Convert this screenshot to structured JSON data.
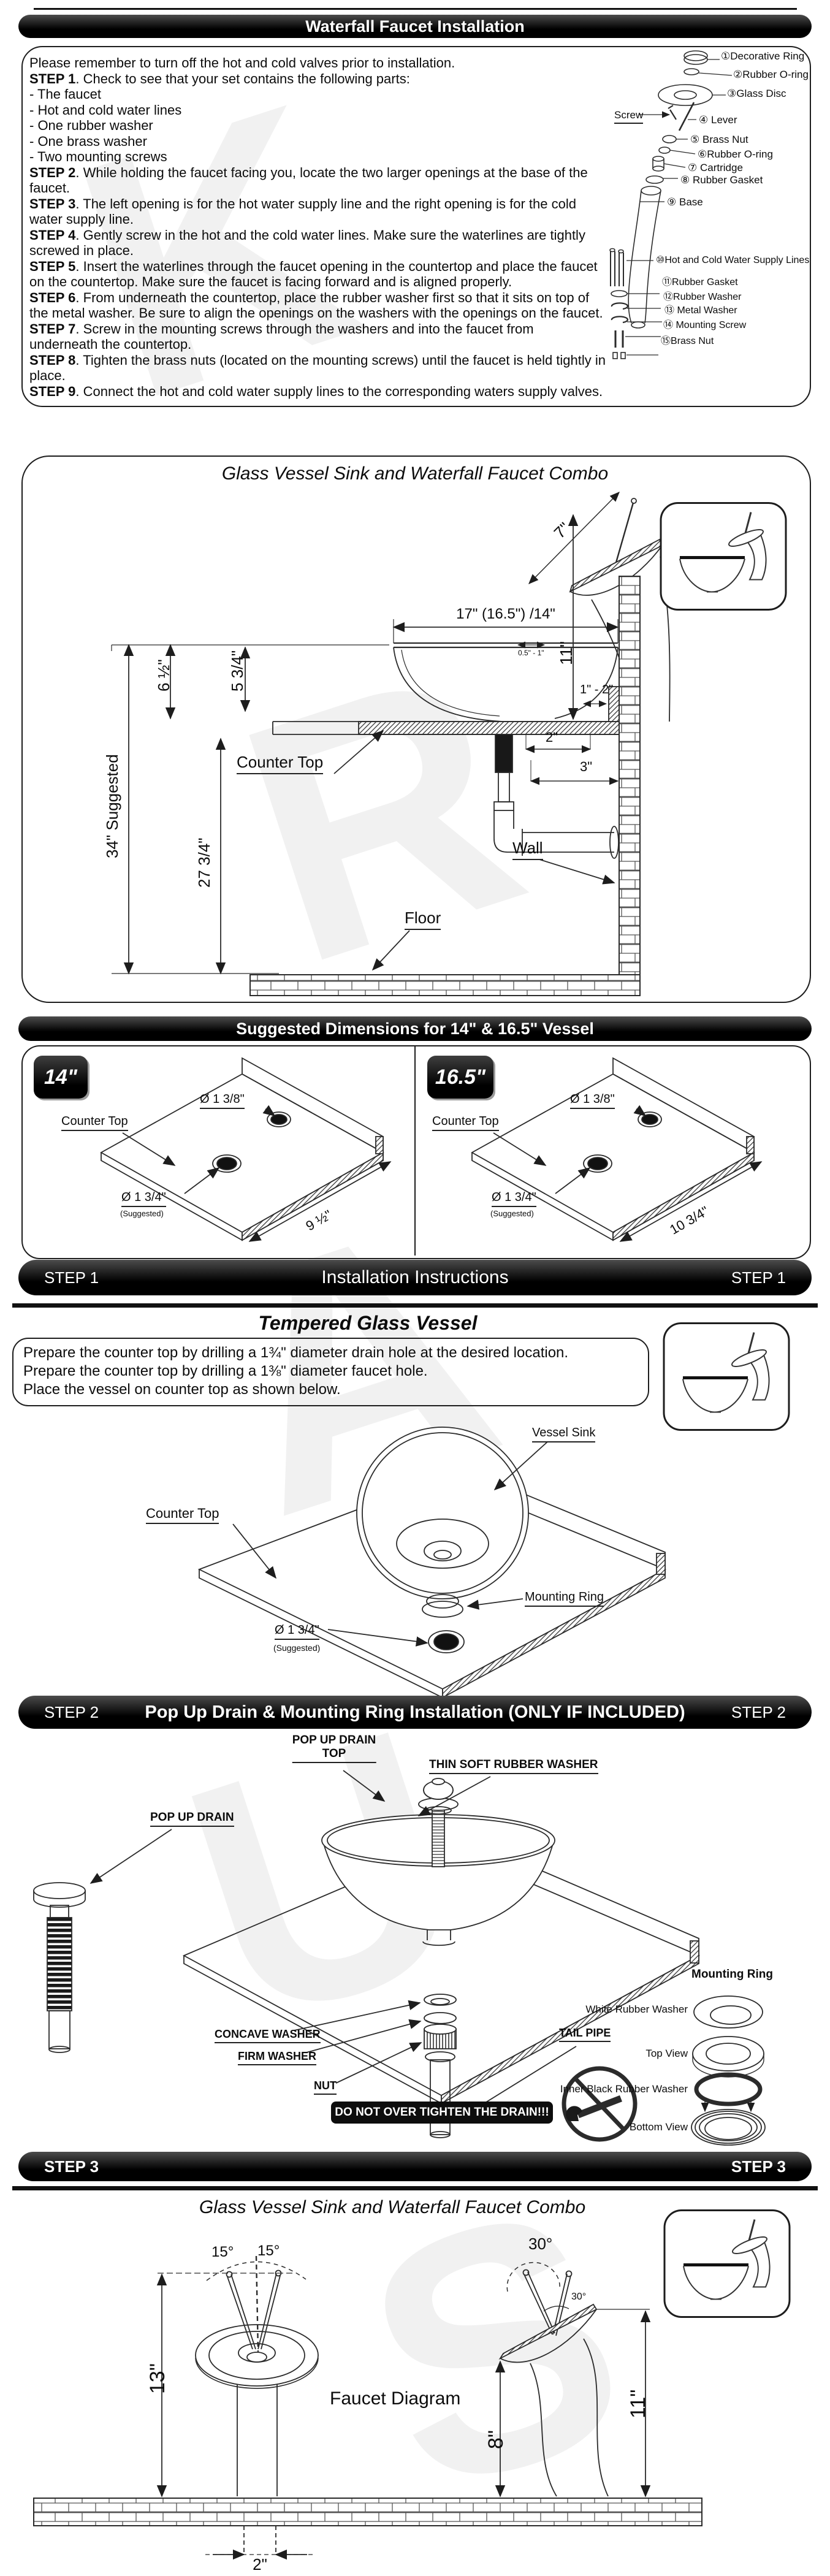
{
  "watermark": {
    "letters": [
      "K",
      "R",
      "A",
      "U",
      "S"
    ]
  },
  "header": {
    "title": "Waterfall Faucet Installation"
  },
  "intro": {
    "lines": [
      {
        "b": "",
        "t": "Please remember to turn off the hot and cold valves prior to installation."
      },
      {
        "b": "STEP 1",
        "t": ". Check to see that your set contains the following parts:"
      },
      {
        "b": "",
        "t": "- The faucet"
      },
      {
        "b": "",
        "t": "- Hot and cold water lines"
      },
      {
        "b": "",
        "t": "- One rubber washer"
      },
      {
        "b": "",
        "t": "- One brass washer"
      },
      {
        "b": "",
        "t": "- Two mounting screws"
      },
      {
        "b": "STEP 2",
        "t": ". While holding the faucet facing you, locate the two larger openings at the base of the faucet."
      },
      {
        "b": "STEP 3",
        "t": ". The left opening is for the hot water supply line and the right opening is for the cold water supply line."
      },
      {
        "b": "STEP 4",
        "t": ". Gently screw in the hot and the cold water lines. Make sure the waterlines are tightly screwed in place."
      },
      {
        "b": "STEP 5",
        "t": ". Insert the waterlines through the faucet opening in the countertop and place the faucet on the countertop. Make sure the faucet is facing forward and is aligned properly."
      },
      {
        "b": "STEP 6",
        "t": ". From underneath the countertop, place the rubber washer first so that it sits on top of the metal washer. Be sure to align the openings on the washers with the openings on the faucet."
      },
      {
        "b": "STEP 7",
        "t": ". Screw in the mounting screws through the washers and into the faucet from underneath the countertop."
      },
      {
        "b": "STEP 8",
        "t": ". Tighten the brass nuts (located on the mounting screws) until the faucet is held tightly in place."
      },
      {
        "b": "STEP 9",
        "t": ".  Connect the hot and cold water supply lines to the corresponding waters supply valves."
      }
    ],
    "screw_label": "Screw",
    "parts": [
      {
        "n": "①",
        "t": "Decorative Ring"
      },
      {
        "n": "②",
        "t": "Rubber O-ring"
      },
      {
        "n": "③",
        "t": "Glass Disc"
      },
      {
        "n": "④",
        "t": "Lever"
      },
      {
        "n": "⑤",
        "t": "Brass Nut"
      },
      {
        "n": "⑥",
        "t": "Rubber O-ring"
      },
      {
        "n": "⑦",
        "t": "Cartridge"
      },
      {
        "n": "⑧",
        "t": "Rubber Gasket"
      },
      {
        "n": "⑨",
        "t": "Base"
      },
      {
        "n": "⑩",
        "t": "Hot and Cold Water Supply Lines"
      },
      {
        "n": "⑪",
        "t": "Rubber Gasket"
      },
      {
        "n": "⑫",
        "t": "Rubber Washer"
      },
      {
        "n": "⑬",
        "t": "Metal Washer"
      },
      {
        "n": "⑭",
        "t": "Mounting Screw"
      },
      {
        "n": "⑮",
        "t": "Brass Nut"
      }
    ]
  },
  "combo": {
    "title": "Glass Vessel Sink and Waterfall Faucet Combo",
    "dims": {
      "d7": "7\"",
      "w": "17\" (16.5\") /14\"",
      "h11": "11\"",
      "h65": "6 ½\"",
      "h575": "5 3/4\"",
      "s34": "34\" Suggested",
      "h2775": "27 3/4\"",
      "g051": "0.5\" - 1\"",
      "g12": "1\" - 2\"",
      "d2": "2\"",
      "d3": "3\""
    },
    "counter_top": "Counter Top",
    "wall": "Wall",
    "floor": "Floor"
  },
  "sug": {
    "title": "Suggested Dimensions for 14\" & 16.5\" Vessel",
    "left": {
      "badge": "14\"",
      "counter": "Counter Top",
      "top_hole": "Ø 1 3/8\"",
      "bottom_hole": "Ø 1 3/4\"",
      "suggested": "(Suggested)",
      "width": "9 ½\""
    },
    "right": {
      "badge": "16.5\"",
      "counter": "Counter Top",
      "top_hole": "Ø 1 3/8\"",
      "bottom_hole": "Ø 1 3/4\"",
      "suggested": "(Suggested)",
      "width": "10 3/4\""
    }
  },
  "step1": {
    "tag": "STEP 1",
    "heading": "Installation Instructions",
    "subtitle": "Tempered Glass Vessel",
    "lines": [
      "Prepare the counter top by drilling a 1¾\" diameter drain hole at the desired location.",
      "Prepare the counter top by drilling a 1⅜\" diameter faucet hole.",
      "Place the vessel on counter top as shown below."
    ],
    "vessel_sink": "Vessel Sink",
    "counter_top": "Counter Top",
    "mounting_ring": "Mounting Ring",
    "hole": "Ø 1 3/4\"",
    "suggested": "(Suggested)"
  },
  "step2": {
    "tag": "STEP 2",
    "heading": "Pop Up Drain & Mounting Ring Installation (ONLY IF INCLUDED)",
    "pud1": "POP UP DRAIN",
    "pud2": "TOP",
    "thin": "THIN SOFT RUBBER WASHER",
    "pud": "POP UP DRAIN",
    "concave": "CONCAVE  WASHER",
    "firm": "FIRM WASHER",
    "nut": "NUT",
    "tail": "TAIL PIPE",
    "warning": "DO NOT OVER TIGHTEN THE DRAIN!!!",
    "mounting_ring": "Mounting Ring",
    "white_washer": "White Rubber Washer",
    "top_view": "Top View",
    "inner_black": "Inner Black Rubber Washer",
    "bottom_view": "Bottom View"
  },
  "step3": {
    "tag": "STEP 3",
    "title": "Glass Vessel Sink and Waterfall Faucet Combo",
    "label": "Faucet Diagram",
    "a15a": "15°",
    "a15b": "15°",
    "a30": "30°",
    "a30s": "30°",
    "h13": "13\"",
    "h8": "8\"",
    "h11": "11\"",
    "w2": "2\""
  }
}
